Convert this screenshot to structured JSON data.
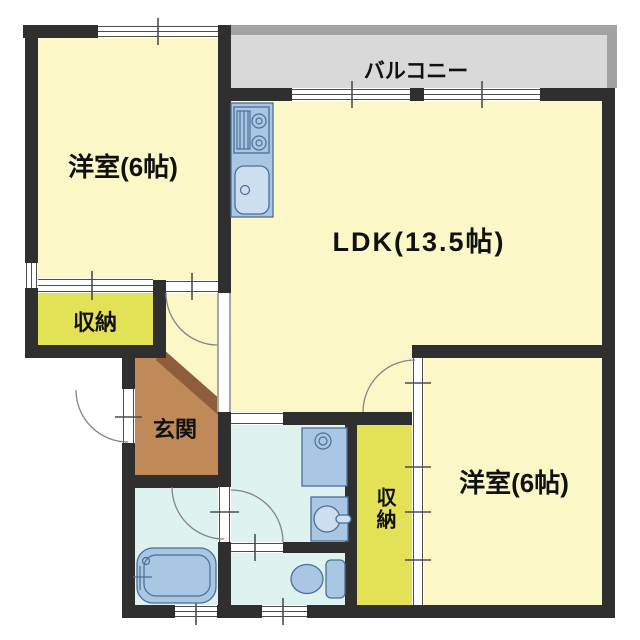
{
  "plan": {
    "labels": {
      "balcony": "バルコニー",
      "room_nw": "洋室(6帖)",
      "ldk": "LDK(13.5帖)",
      "room_se": "洋室(6帖)",
      "storage_west": "収納",
      "storage_east": "収納",
      "entrance": "玄関"
    }
  },
  "colors": {
    "wall": "#2f2f2f",
    "room_yellow": "#fbf7c6",
    "storage_yellow": "#e3e156",
    "wet_cyan": "#def2f0",
    "entrance_brown": "#bf8a57",
    "entrance_diag": "#8e5d3c",
    "balcony_fill": "#d9d9d9",
    "balcony_border": "#a3a3a3",
    "fixture_blue": "#a9c6e2",
    "fixture_light": "#cbdff0",
    "fixture_stroke": "#4d6e96",
    "line": "#4d4d4d",
    "label": "#111111"
  }
}
